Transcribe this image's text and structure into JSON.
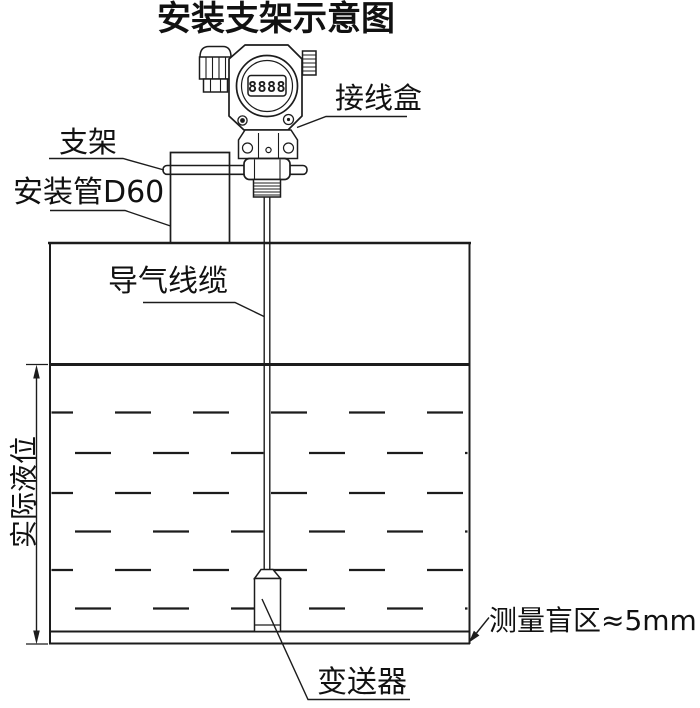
{
  "title": "安装支架示意图",
  "labels": {
    "junction_box": "接线盒",
    "bracket": "支架",
    "mounting_pipe": "安装管D60",
    "air_cable": "导气线缆",
    "actual_level": "实际液位",
    "probe": "变送器",
    "blind_zone": "测量盲区≈5mm"
  },
  "device": {
    "display_digits": "8888"
  },
  "colors": {
    "line": "#1c1c1c",
    "background": "#ffffff",
    "text": "#111111"
  }
}
